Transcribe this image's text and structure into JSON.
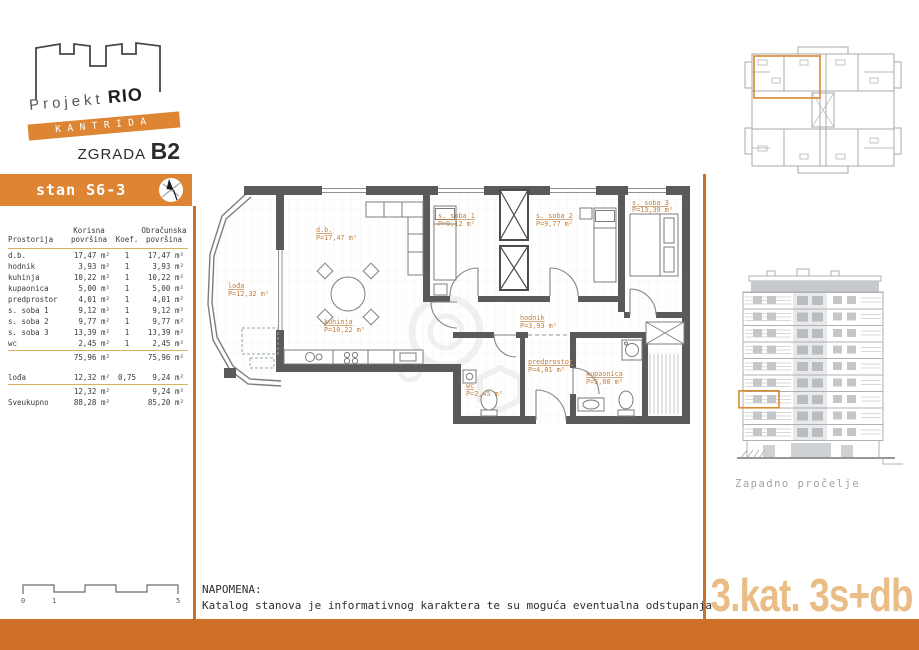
{
  "logo": {
    "project": "Projekt",
    "project_bold": "RIO",
    "ribbon": "KANTRIDA",
    "building_label": "ZGRADA",
    "building_code": "B2"
  },
  "unit_banner": {
    "label": "stan S6-3"
  },
  "table": {
    "headers": {
      "room": "Prostorija",
      "useful": "Korisna\npovršina",
      "coef": "Koef.",
      "calculated": "Obračunska\npovršina"
    },
    "rows": [
      {
        "name": "d.b.",
        "useful": "17,47 m²",
        "coef": "1",
        "calc": "17,47 m²"
      },
      {
        "name": "hodnik",
        "useful": "3,93 m²",
        "coef": "1",
        "calc": "3,93 m²"
      },
      {
        "name": "kuhinja",
        "useful": "10,22 m²",
        "coef": "1",
        "calc": "10,22 m²"
      },
      {
        "name": "kupaonica",
        "useful": "5,00 m²",
        "coef": "1",
        "calc": "5,00 m²"
      },
      {
        "name": "predprostor",
        "useful": "4,01 m²",
        "coef": "1",
        "calc": "4,01 m²"
      },
      {
        "name": "s. soba 1",
        "useful": "9,12 m²",
        "coef": "1",
        "calc": "9,12 m²"
      },
      {
        "name": "s. soba 2",
        "useful": "9,77 m²",
        "coef": "1",
        "calc": "9,77 m²"
      },
      {
        "name": "s. soba 3",
        "useful": "13,39 m²",
        "coef": "1",
        "calc": "13,39 m²"
      },
      {
        "name": "wc",
        "useful": "2,45 m²",
        "coef": "1",
        "calc": "2,45 m²"
      }
    ],
    "subtotal1": {
      "useful": "75,96 m²",
      "calc": "75,96 m²"
    },
    "loggia_row": {
      "name": "lođa",
      "useful": "12,32 m²",
      "coef": "0,75",
      "calc": "9,24 m²"
    },
    "subtotal2": {
      "useful": "12,32 m²",
      "calc": "9,24 m²"
    },
    "total": {
      "name": "Sveukupno",
      "useful": "88,28 m²",
      "calc": "85,20 m²"
    }
  },
  "plan": {
    "rooms": [
      {
        "name": "lođa",
        "area": "P=12,32 m²"
      },
      {
        "name": "d.b.",
        "area": "P=17,47 m²"
      },
      {
        "name": "kuhinja",
        "area": "P=10,22 m²"
      },
      {
        "name": "s. soba 1",
        "area": "P=9,12 m²"
      },
      {
        "name": "s. soba 2",
        "area": "P=9,77 m²"
      },
      {
        "name": "s. soba 3",
        "area": "P=13,39 m²"
      },
      {
        "name": "hodnik",
        "area": "P=3,93 m²"
      },
      {
        "name": "predprostor",
        "area": "P=4,01 m²"
      },
      {
        "name": "kupaonica",
        "area": "P=5,00 m²"
      },
      {
        "name": "wc",
        "area": "P=2,45 m²"
      }
    ]
  },
  "elevation": {
    "caption": "Zapadno pročelje"
  },
  "scale_bar": {
    "tick0": "0",
    "tick1": "1",
    "tick5": "5"
  },
  "note": {
    "title": "NAPOMENA:",
    "body": "Katalog stanova je informativnog karaktera te su moguća eventualna odstupanja"
  },
  "floor_label": "3.kat. 3s+db",
  "colors": {
    "accent_orange": "#de8534",
    "accent_dark_orange": "#cf7028",
    "floor_label_text": "#e9bd85",
    "table_rule": "#d8b25e",
    "plan_label": "#c4803c",
    "wall": "#5a5a5a"
  }
}
